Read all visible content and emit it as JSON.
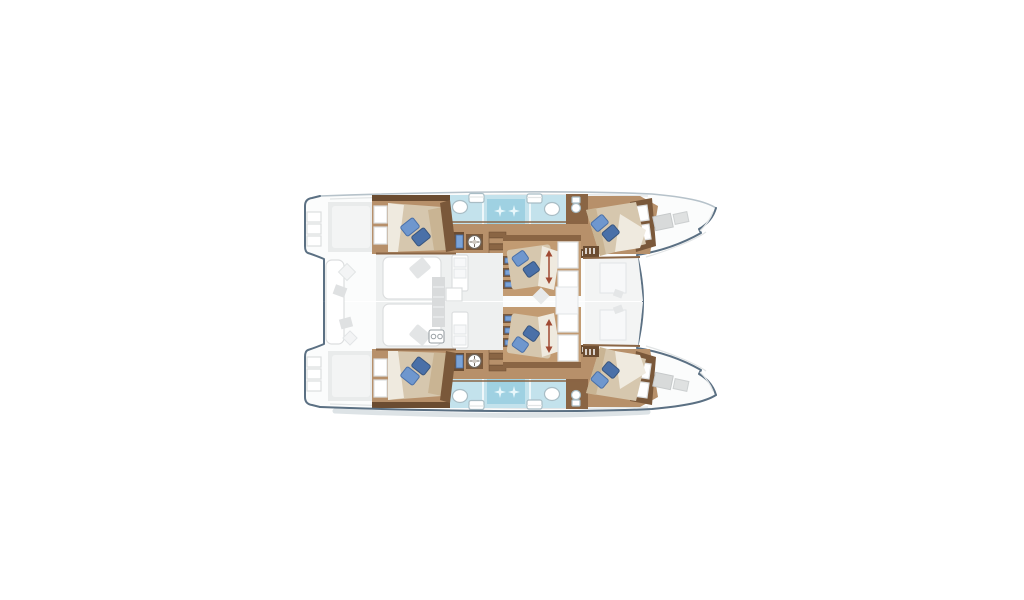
{
  "meta": {
    "title": "Catamaran deck plan",
    "description": "Top-down floor plan of a sailing catamaran, bow pointing right, centered on a white background: two hulls each with an aft double cabin, a shower/WC strip and a forward double cabin, plus two central double cabins on the bridgedeck, a saloon with galley, an aft cockpit and bow hatches.",
    "background": "#ffffff"
  },
  "layout_summary": {
    "hulls": 2,
    "double_berths": 6,
    "pillows": 12,
    "sinks": 4,
    "toilets": 4,
    "shower_compartments": 2,
    "companionway_stairs": 2,
    "wardrobe_units": 2,
    "storage_lockers": 4,
    "fan_icons": 2,
    "bow_hatches": 4,
    "height_adjust_arrows": 2
  },
  "icons": {
    "pillow-icon": "rotated blue rectangle",
    "sink-icon": "white oval basin",
    "toilet-icon": "white rounded rectangle",
    "shower-sparkle-icon": "four-point white star on cyan",
    "fan-icon": "white circle with cross spokes",
    "locker-icon": "small blue door rectangle",
    "updown-arrow-icon": "red double-headed vertical arrow",
    "stove-icon": "white square with two burner circles",
    "bow-hatch-icon": "tilted grey square"
  },
  "colors": {
    "background": "#ffffff",
    "outline": "#5b7083",
    "outlineLight": "#b6c2ca",
    "shadowSoft": "#dde3e6",
    "hullFill": "#fbfcfc",
    "deck": "#e9ebeb",
    "deckLight": "#f3f4f4",
    "salonFloor": "#eef0f0",
    "panel": "#f7f8f9",
    "lineFaint": "#e2e5e6",
    "furnitureStroke": "#dcdedf",
    "wood": "#b7906a",
    "woodPale": "#c29b72",
    "woodDark": "#6b4c31",
    "woodMid": "#8a6544",
    "woodTrim": "#7a583a",
    "bed": "#d6c7ae",
    "bedShade": "#c9b493",
    "sheet": "#efeadf",
    "pillow": "#6f97ce",
    "pillowDark": "#4a70a8",
    "bath": "#c3e2ec",
    "shower": "#9fd1e2",
    "sparkle": "#e8f7fb",
    "dividerWhite": "#eef7fa",
    "fixtureStroke": "#a9bdc5",
    "hatch": "#d8dada",
    "shelfBlue": "#7aa3d8",
    "arrow": "#a04a33",
    "rug": "#d9dbdc",
    "rugStripe": "#e9ebec"
  }
}
